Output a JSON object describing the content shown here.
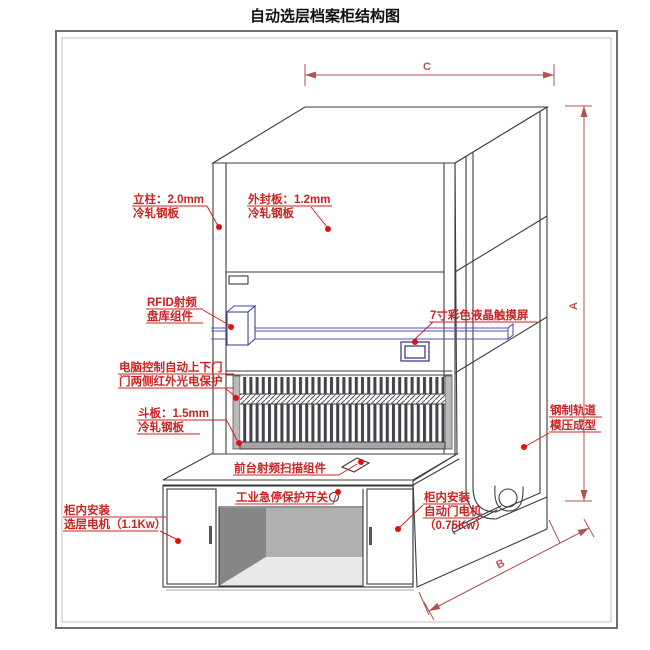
{
  "title": "自动选层档案柜结构图",
  "colors": {
    "label_red": "#cc2222",
    "dot_red": "#e01010",
    "dimension_red": "#b05252",
    "outline": "#3c3c3c",
    "rail_purple": "#5252b4",
    "rfid_purple": "#4646a8",
    "screen_navy": "#2e2e74"
  },
  "dimensions": {
    "width_top": "C",
    "height_right": "A",
    "depth_bottom": "B"
  },
  "labels": {
    "column": [
      "立柱：2.0mm",
      "冷轧钢板"
    ],
    "outer_panel": [
      "外封板：1.2mm",
      "冷轧钢板"
    ],
    "rfid": [
      "RFID射频",
      "盘库组件"
    ],
    "touchscreen": [
      "7寸彩色液晶触摸屏"
    ],
    "auto_door": [
      "电脑控制自动上下门",
      "门两侧红外光电保护"
    ],
    "hopper_panel": [
      "斗板：1.5mm",
      "冷轧钢板"
    ],
    "front_scanner": [
      "前台射频扫描组件"
    ],
    "estop": [
      "工业急停保护开关"
    ],
    "layer_motor": [
      "柜内安装",
      "选层电机（1.1Kw）"
    ],
    "door_motor": [
      "柜内安装",
      "自动门电机",
      "（0.75Kw）"
    ],
    "steel_track": [
      "钢制轨道",
      "模压成型"
    ]
  }
}
